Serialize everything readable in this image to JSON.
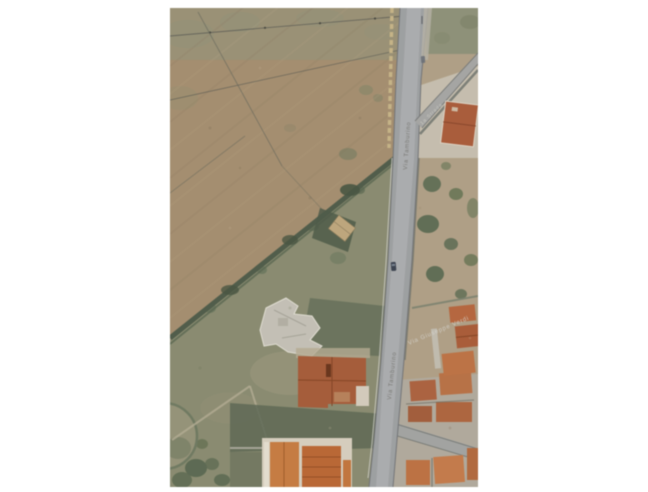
{
  "window": {
    "width": 648,
    "height": 492,
    "background": "#ffffff",
    "description": "Scanned aerial orthophoto print centered on a white page"
  },
  "photo": {
    "kind": "aerial-orthophoto",
    "position": {
      "left": 170,
      "top": 8,
      "width": 308,
      "height": 479
    },
    "scene": "Semi-rural parcel: plowed field and scrub to the west of a north-south road; terracotta-roofed houses along and east of the road; building cluster at bottom",
    "labels": {
      "main_road": "Via Tamburino",
      "main_road_repeat": "Via Tamburino",
      "cross_street": "Via Giuseppe Verdi",
      "branch_road": "1a Strada"
    },
    "palette": {
      "plowed_field": "#a78e6c",
      "field_olive_tint": "#96957a",
      "scrub_green": "#8a8c6e",
      "tree_dark_green": "#5d6b50",
      "hedge_dark": "#4e5c47",
      "road_gray": "#9ea1a3",
      "road_center_light": "#b4b6b7",
      "road_edge_dark": "#6e7174",
      "wall_tan_dashed": "#c9b583",
      "concrete_pale": "#c9c0ae",
      "roof_terracotta": "#ac5a34",
      "roof_orange_bright": "#cd7b3a",
      "roof_red_top": "#b05a35",
      "unfinished_building_gray": "#c6c2b6",
      "shadow_dark": "#5d6852",
      "right_ground_tan": "#b2a084",
      "car_dark": "#3a4250"
    }
  }
}
